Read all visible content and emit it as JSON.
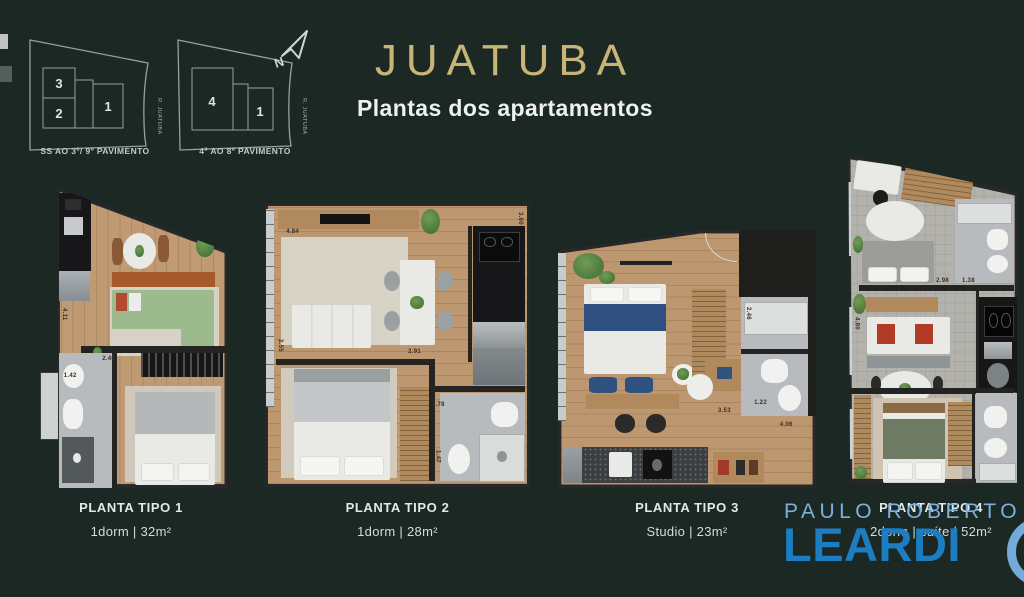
{
  "page": {
    "title": "JUATUBA",
    "subtitle": "Plantas dos apartamentos"
  },
  "site_diagrams": {
    "north_label": "N",
    "items": [
      {
        "caption": "SS AO 3º/ 9º PAVIMENTO",
        "street": "R. JUATUBA",
        "units": [
          "3",
          "2",
          "1"
        ]
      },
      {
        "caption": "4º AO 8º PAVIMENTO",
        "street": "R. JUATUBA",
        "units": [
          "4",
          "1"
        ]
      }
    ]
  },
  "plans": [
    {
      "name": "PLANTA TIPO 1",
      "spec": "1dorm | 32m²",
      "dims": [
        "4.11",
        "2.40",
        "1.42"
      ]
    },
    {
      "name": "PLANTA TIPO 2",
      "spec": "1dorm | 28m²",
      "dims": [
        "4.84",
        "3.60",
        "2.55",
        "2.91",
        "1.78",
        "1.47"
      ]
    },
    {
      "name": "PLANTA TIPO 3",
      "spec": "Studio | 23m²",
      "dims": [
        "2.46",
        "1.22",
        "3.53",
        "4.06"
      ]
    },
    {
      "name": "PLANTA TIPO 4",
      "spec": "2dorm | suíte | 52m²",
      "dims": [
        "4.80",
        "2.98",
        "1.38"
      ]
    }
  ],
  "watermark": {
    "line1": "PAULO ROBERTO",
    "line2": "LEARDI"
  },
  "colors": {
    "background": "#1c2823",
    "title_gold": "#c9b478",
    "text": "#e8eeeb",
    "watermark_light_blue": "#7cb0de",
    "watermark_blue": "#1d7dc3",
    "diagram_line": "#93a39c"
  }
}
